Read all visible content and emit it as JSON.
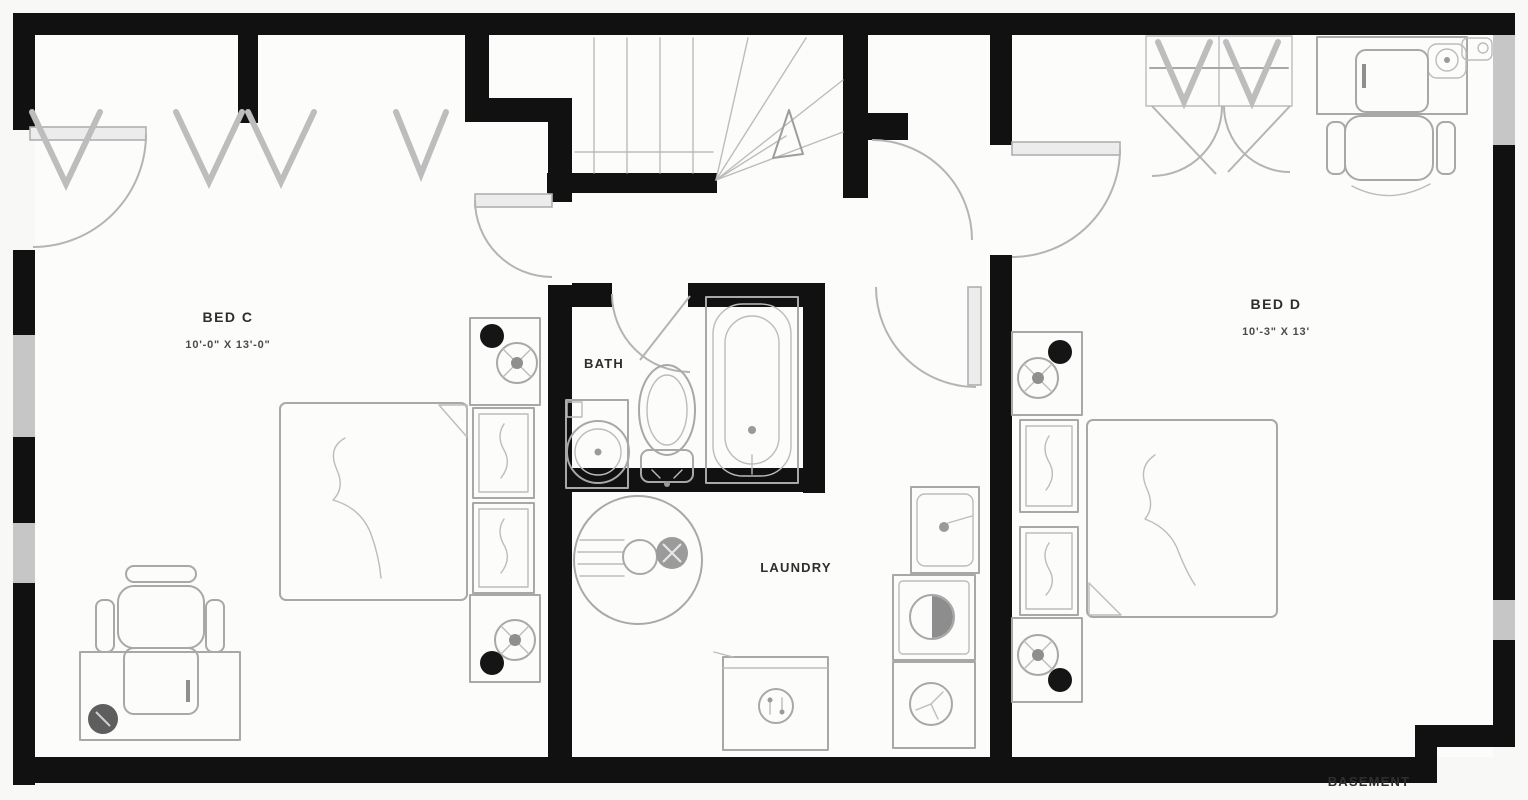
{
  "plan": {
    "title": "BASEMENT",
    "rooms": {
      "bed_c": {
        "name": "BED C",
        "dimensions": "10'-0\" X 13'-0\""
      },
      "bed_d": {
        "name": "BED D",
        "dimensions": "10'-3\" X 13'"
      },
      "bath": {
        "name": "BATH"
      },
      "laundry": {
        "name": "LAUNDRY"
      }
    },
    "fixtures": [
      "stairs-up",
      "bathtub",
      "toilet",
      "vanity-sink",
      "water-heater",
      "furnace",
      "laundry-sink",
      "washer",
      "dryer",
      "bed",
      "nightstand-lamp",
      "dresser",
      "desk",
      "office-chair",
      "closet-hangers"
    ],
    "colors": {
      "wall": "#111111",
      "window": "#c6c6c6",
      "fixture_line": "#a8a8a8",
      "background": "#f8f8f7",
      "text": "#2e2e2e"
    }
  }
}
